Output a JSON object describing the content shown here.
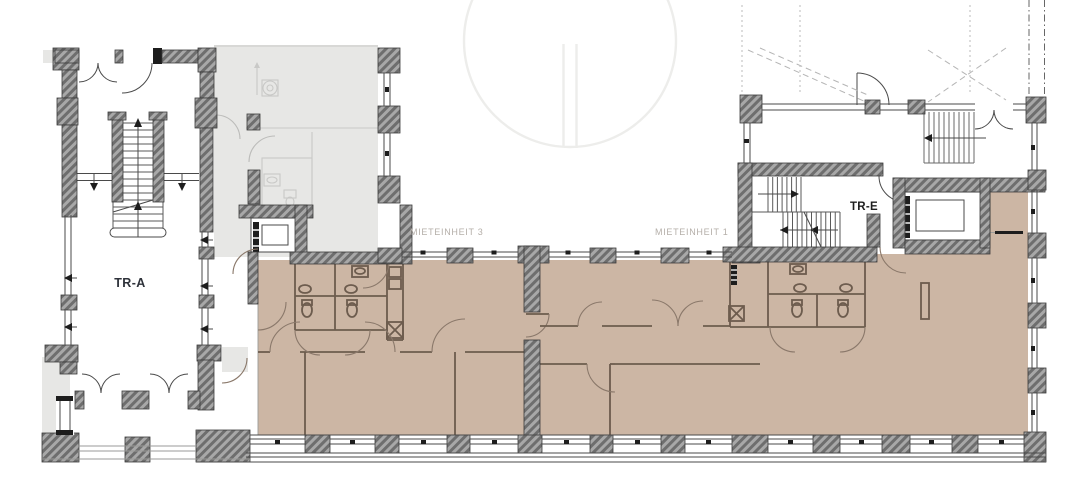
{
  "plan": {
    "labels": {
      "tr_a": "TR-A",
      "tr_e": "TR-E",
      "unit_3": "MIETEINHEIT 3",
      "unit_1": "MIETEINHEIT 1"
    },
    "colors": {
      "rental_unit_fill": "#ccb6a4",
      "secondary_area_fill": "#e7e7e5",
      "wall_hatch_dark": "#6e6e6e",
      "wall_hatch_light": "#a8a8a8",
      "partition_line": "#6d5c4e",
      "label_dark": "#2e323a",
      "label_muted": "#b5afa9",
      "watermark": "#ededeb"
    }
  }
}
